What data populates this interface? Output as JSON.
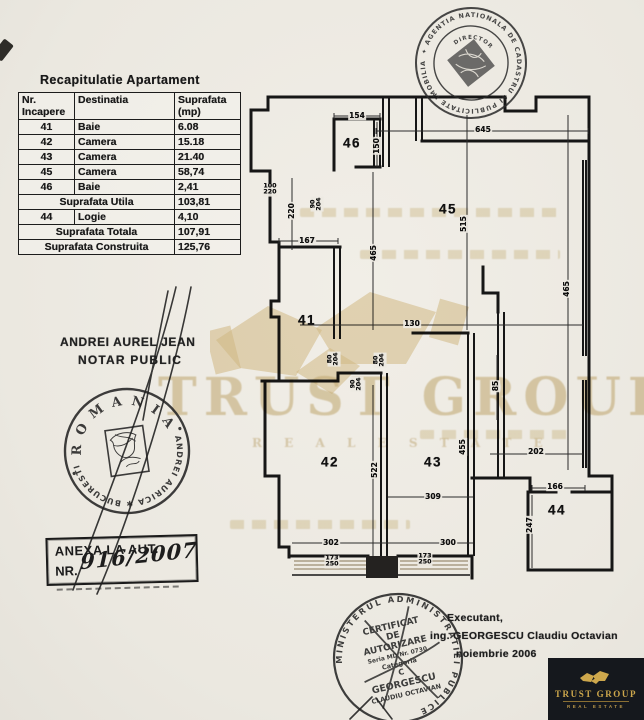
{
  "colors": {
    "paper": "#edeae3",
    "ink": "#1a1a1a",
    "watermark": "#cdb680",
    "logo_bg": "#15181d",
    "logo_gold": "#cda74c"
  },
  "table": {
    "title": "Recapitulatie Apartament",
    "headers": [
      {
        "l1": "Nr.",
        "l2": "Incapere"
      },
      {
        "l1": "Destinatia",
        "l2": ""
      },
      {
        "l1": "Suprafata",
        "l2": "(mp)"
      }
    ],
    "rows": [
      [
        {
          "t": "41",
          "a": "c"
        },
        {
          "t": "Baie",
          "a": "l"
        },
        {
          "t": "6.08",
          "a": "l"
        }
      ],
      [
        {
          "t": "42",
          "a": "c"
        },
        {
          "t": "Camera",
          "a": "l"
        },
        {
          "t": "15.18",
          "a": "l"
        }
      ],
      [
        {
          "t": "43",
          "a": "c"
        },
        {
          "t": "Camera",
          "a": "l"
        },
        {
          "t": "21.40",
          "a": "l"
        }
      ],
      [
        {
          "t": "45",
          "a": "c"
        },
        {
          "t": "Camera",
          "a": "l"
        },
        {
          "t": "58,74",
          "a": "l"
        }
      ],
      [
        {
          "t": "46",
          "a": "c"
        },
        {
          "t": "Baie",
          "a": "l"
        },
        {
          "t": "2,41",
          "a": "l"
        }
      ],
      [
        {
          "t": "Suprafata Utila",
          "s": 2,
          "a": "c"
        },
        {
          "t": "103,81",
          "a": "l"
        }
      ],
      [
        {
          "t": "44",
          "a": "c"
        },
        {
          "t": "Logie",
          "a": "l"
        },
        {
          "t": "4,10",
          "a": "l"
        }
      ],
      [
        {
          "t": "Suprafata Totala",
          "s": 2,
          "a": "c"
        },
        {
          "t": "107,91",
          "a": "l"
        }
      ],
      [
        {
          "t": "Suprafata Construita",
          "s": 2,
          "a": "c"
        },
        {
          "t": "125,76",
          "a": "l"
        }
      ]
    ]
  },
  "plan": {
    "rooms": [
      {
        "id": "46",
        "x": 352,
        "y": 143
      },
      {
        "id": "45",
        "x": 448,
        "y": 209
      },
      {
        "id": "41",
        "x": 307,
        "y": 320
      },
      {
        "id": "42",
        "x": 330,
        "y": 462
      },
      {
        "id": "43",
        "x": 433,
        "y": 462
      },
      {
        "id": "44",
        "x": 557,
        "y": 510
      }
    ],
    "dims": [
      {
        "t": "154",
        "x": 357,
        "y": 116
      },
      {
        "t": "645",
        "x": 483,
        "y": 130
      },
      {
        "t": "150",
        "x": 377,
        "y": 146,
        "r": -90
      },
      {
        "t": "100/220",
        "x": 270,
        "y": 190,
        "stack": true
      },
      {
        "t": "220",
        "x": 292,
        "y": 211,
        "r": -90
      },
      {
        "t": "167",
        "x": 307,
        "y": 241
      },
      {
        "t": "90/204",
        "x": 317,
        "y": 204,
        "r": -90,
        "stack": true
      },
      {
        "t": "465",
        "x": 374,
        "y": 253,
        "r": -90
      },
      {
        "t": "515",
        "x": 464,
        "y": 224,
        "r": -90
      },
      {
        "t": "465",
        "x": 567,
        "y": 289,
        "r": -90
      },
      {
        "t": "130",
        "x": 412,
        "y": 324
      },
      {
        "t": "80/204",
        "x": 334,
        "y": 359,
        "r": -90,
        "stack": true
      },
      {
        "t": "80/204",
        "x": 380,
        "y": 360,
        "r": -90,
        "stack": true
      },
      {
        "t": "90/204",
        "x": 357,
        "y": 384,
        "r": -90,
        "stack": true
      },
      {
        "t": "85",
        "x": 496,
        "y": 386,
        "r": -90
      },
      {
        "t": "455",
        "x": 463,
        "y": 447,
        "r": -90
      },
      {
        "t": "522",
        "x": 375,
        "y": 470,
        "r": -90
      },
      {
        "t": "309",
        "x": 433,
        "y": 497
      },
      {
        "t": "202",
        "x": 536,
        "y": 452
      },
      {
        "t": "166",
        "x": 555,
        "y": 487
      },
      {
        "t": "247",
        "x": 530,
        "y": 525,
        "r": -90
      },
      {
        "t": "302",
        "x": 331,
        "y": 543
      },
      {
        "t": "300",
        "x": 448,
        "y": 543
      },
      {
        "t": "173/250",
        "x": 332,
        "y": 562,
        "stack": true
      },
      {
        "t": "173/250",
        "x": 425,
        "y": 560,
        "stack": true
      }
    ]
  },
  "notary": {
    "line1": "ANDREI AUREL JEAN",
    "line2": "NOTAR PUBLIC"
  },
  "notary_stamp": {
    "top": "R O M A N I A",
    "bottom": "ANDREI AURICA ✱ BUCURESTI"
  },
  "cadastru_stamp": {
    "ring": "✦ AGENTIA NATIONALA DE CADASTRU SI PUBLICITATE IMOBILIARA ✦",
    "inner": "DIRECTOR"
  },
  "ministry_stamp": {
    "ring": "MINISTERUL ADMINISTRATIEI PUBLICE",
    "l1": "CERTIFICAT",
    "l2": "DE",
    "l3": "AUTORIZARE",
    "l4": "Seria MD Nr. 0730",
    "l5": "Categoria",
    "l6": "C",
    "l7": "GEORGESCU",
    "l8": "CLAUDIU OCTAVIAN"
  },
  "anexa": {
    "line1": "ANEXA LA AUT.",
    "line2": "NR.",
    "handwritten": "916/2007"
  },
  "executant": {
    "l1": "Executant,",
    "l2": "ing. GEORGESCU Claudiu Octavian",
    "l3": "noiembrie 2006"
  },
  "watermark": {
    "title": "TRUST GROUP",
    "subtitle": "R E A L   E S T A T E"
  },
  "logo": {
    "title": "TRUST GROUP",
    "subtitle": "REAL ESTATE"
  }
}
